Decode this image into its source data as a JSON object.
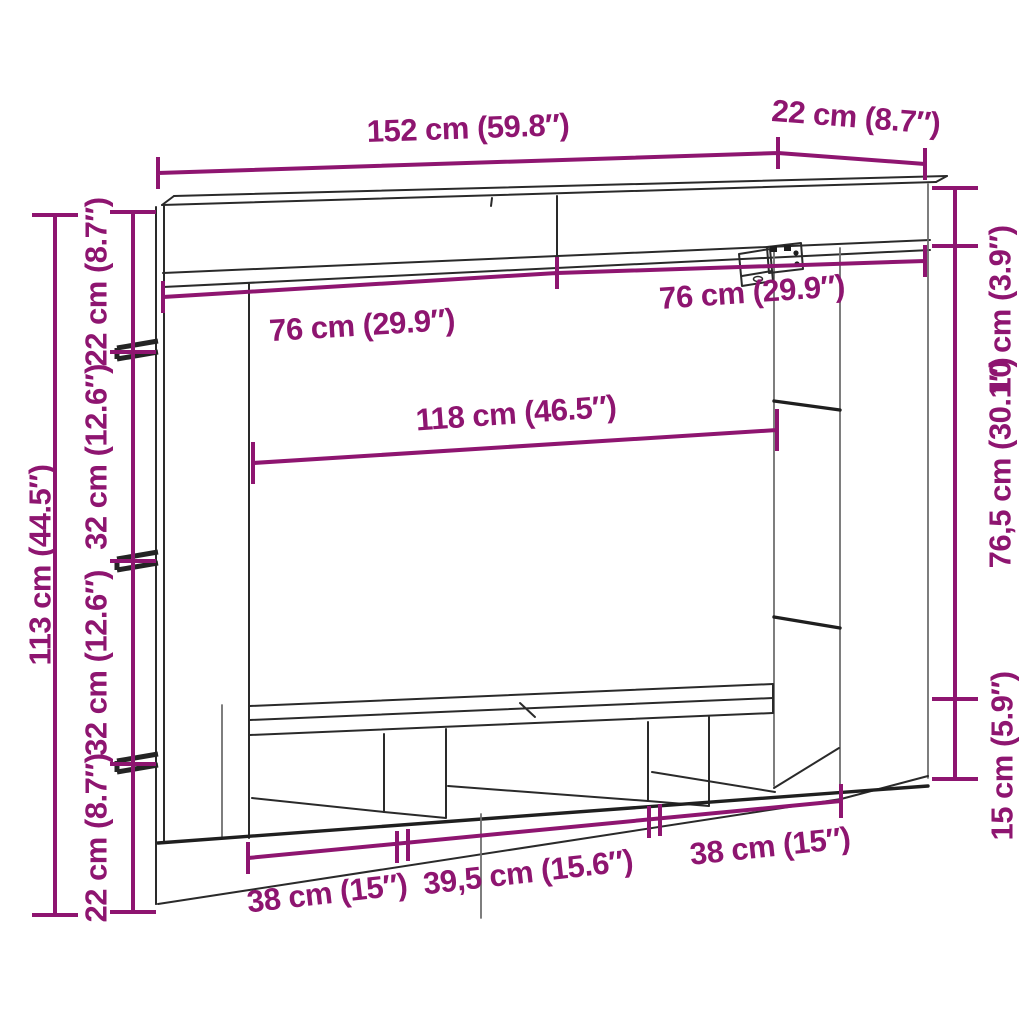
{
  "diagram": {
    "title": "TV wall unit dimension diagram",
    "style": {
      "dimension_color": "#8E1570",
      "line_color": "#2A2A2A",
      "background": "#FFFFFF"
    },
    "dims": {
      "width_total": "152 cm (59.8″)",
      "depth_top": "22 cm (8.7″)",
      "right_top_height": "10 cm (3.9″)",
      "right_mid_height": "76,5 cm (30.1″)",
      "right_bottom_height": "15 cm (5.9″)",
      "left_total_height": "113 cm (44.5″)",
      "left_seg_1": "22 cm (8.7″)",
      "left_seg_2": "32 cm (12.6″)",
      "left_seg_3": "32 cm (12.6″)",
      "left_seg_4": "22 cm (8.7″)",
      "top_left_width": "76 cm (29.9″)",
      "top_right_width": "76 cm (29.9″)",
      "middle_width": "118 cm (46.5″)",
      "bottom_seg_1": "38 cm (15″)",
      "bottom_seg_2": "39,5 cm (15.6″)",
      "bottom_seg_3": "38 cm (15″)"
    }
  }
}
